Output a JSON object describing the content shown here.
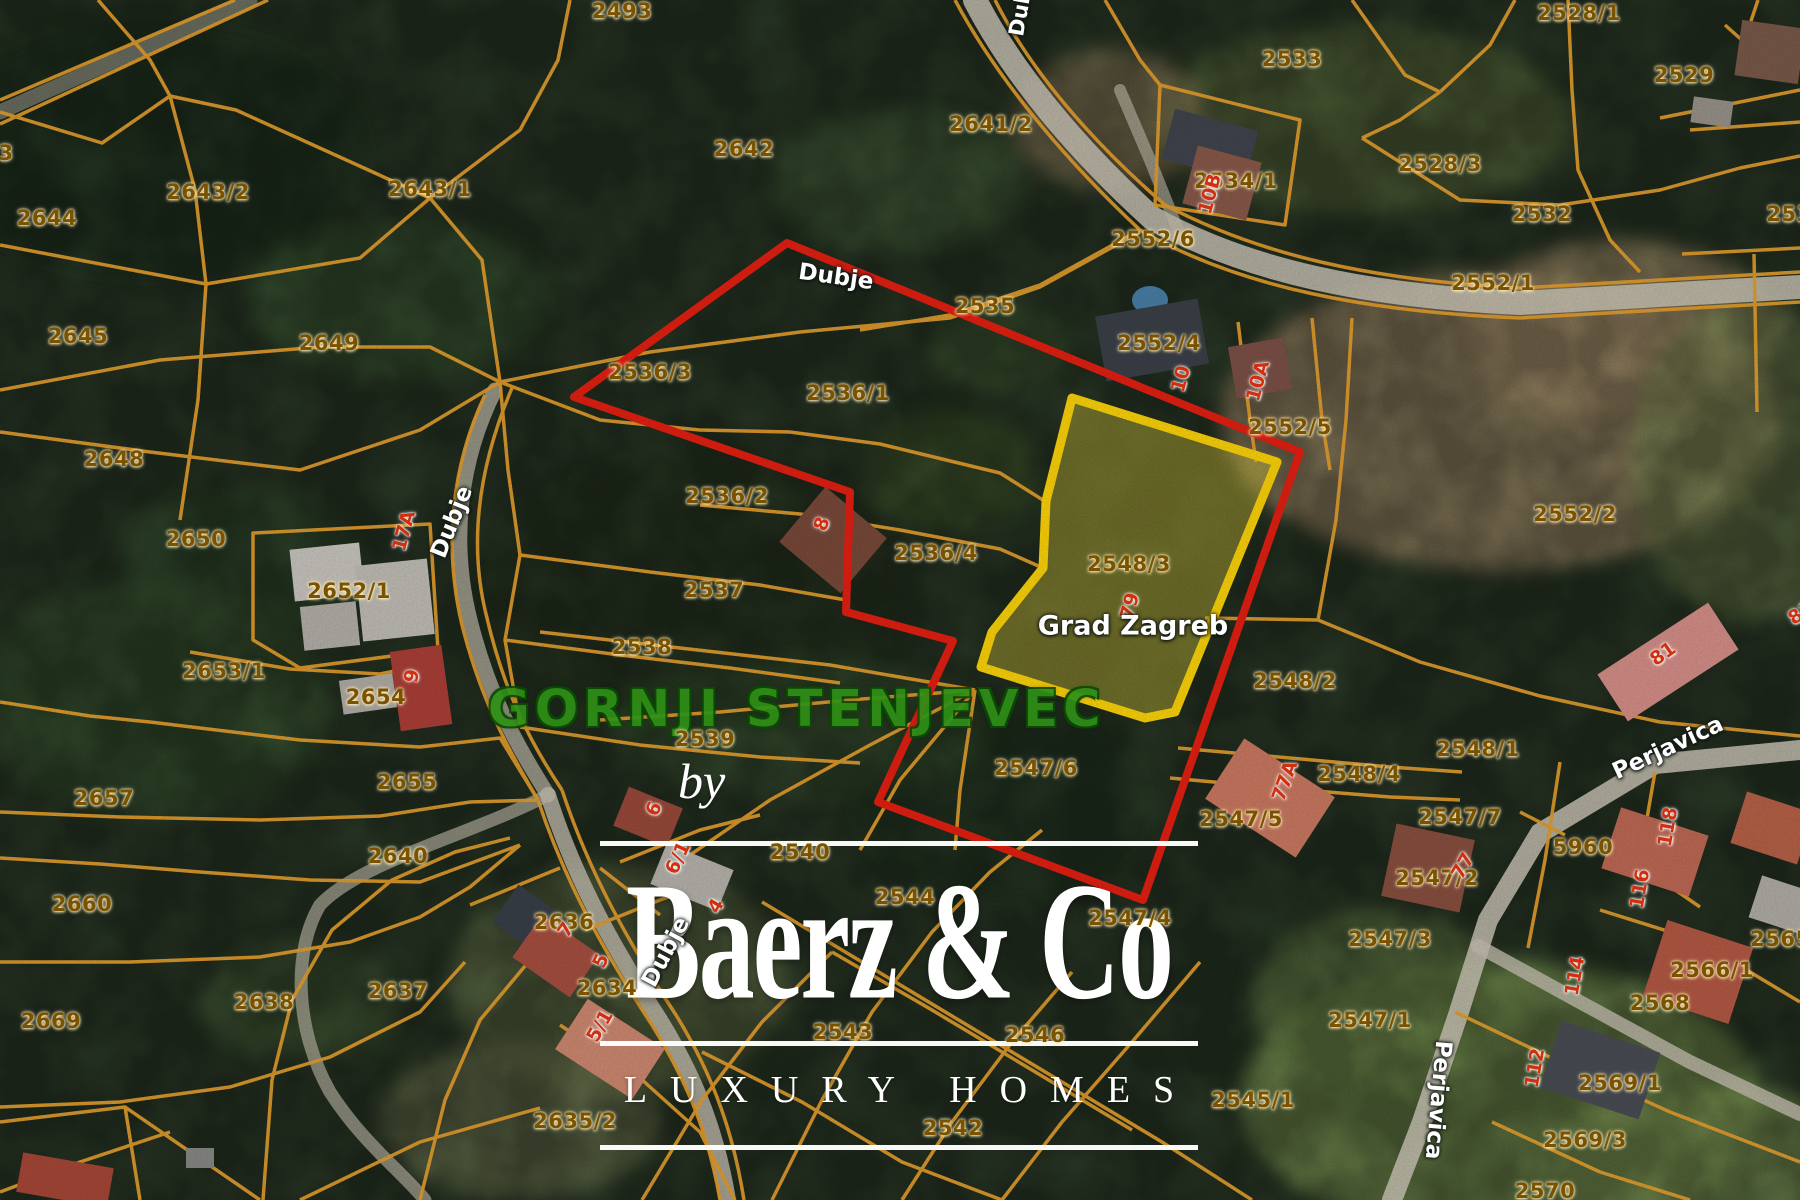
{
  "map": {
    "region_label": "GORNJI STENJEVEC",
    "highlighted_parcel": "2548/3",
    "colors": {
      "boundary_red": "#e62012",
      "parcel_highlight_yellow": "#ffd60a",
      "cadastral_orange": "#e6a02e",
      "parcel_text": "#7a5200",
      "house_number_red": "#d03010",
      "watermark_white": "#ffffff",
      "region_green": "#2f9016"
    },
    "parcel_labels": [
      {
        "t": "2493",
        "x": 622,
        "y": 11
      },
      {
        "t": "2643/2",
        "x": 208,
        "y": 192
      },
      {
        "t": "2643/1",
        "x": 430,
        "y": 189
      },
      {
        "t": "2644",
        "x": 47,
        "y": 218
      },
      {
        "t": "2642",
        "x": 744,
        "y": 149
      },
      {
        "t": "2641/2",
        "x": 991,
        "y": 124
      },
      {
        "t": "2645",
        "x": 78,
        "y": 336
      },
      {
        "t": "2649",
        "x": 329,
        "y": 343
      },
      {
        "t": "2648",
        "x": 114,
        "y": 459
      },
      {
        "t": "2650",
        "x": 196,
        "y": 539
      },
      {
        "t": "2652/1",
        "x": 349,
        "y": 591
      },
      {
        "t": "2653/1",
        "x": 224,
        "y": 671
      },
      {
        "t": "2654",
        "x": 376,
        "y": 697
      },
      {
        "t": "2655",
        "x": 407,
        "y": 782
      },
      {
        "t": "2657",
        "x": 104,
        "y": 798
      },
      {
        "t": "2660",
        "x": 82,
        "y": 904
      },
      {
        "t": "2669",
        "x": 51,
        "y": 1021
      },
      {
        "t": "2638",
        "x": 264,
        "y": 1002
      },
      {
        "t": "2637",
        "x": 398,
        "y": 991
      },
      {
        "t": "2640",
        "x": 398,
        "y": 856
      },
      {
        "t": "2636",
        "x": 564,
        "y": 922
      },
      {
        "t": "2634",
        "x": 607,
        "y": 988
      },
      {
        "t": "2635/2",
        "x": 575,
        "y": 1121
      },
      {
        "t": "2535",
        "x": 985,
        "y": 306
      },
      {
        "t": "2536/3",
        "x": 650,
        "y": 372
      },
      {
        "t": "2536/1",
        "x": 848,
        "y": 393
      },
      {
        "t": "2536/2",
        "x": 727,
        "y": 496
      },
      {
        "t": "2536/4",
        "x": 936,
        "y": 553
      },
      {
        "t": "2537",
        "x": 714,
        "y": 590
      },
      {
        "t": "2538",
        "x": 642,
        "y": 647
      },
      {
        "t": "2539",
        "x": 705,
        "y": 739
      },
      {
        "t": "2540",
        "x": 800,
        "y": 852
      },
      {
        "t": "2543",
        "x": 843,
        "y": 1032
      },
      {
        "t": "2544",
        "x": 905,
        "y": 897
      },
      {
        "t": "2546",
        "x": 1035,
        "y": 1035
      },
      {
        "t": "2542",
        "x": 953,
        "y": 1128
      },
      {
        "t": "2552/6",
        "x": 1153,
        "y": 239
      },
      {
        "t": "2534/1",
        "x": 1236,
        "y": 181
      },
      {
        "t": "2552/4",
        "x": 1159,
        "y": 343
      },
      {
        "t": "2552/5",
        "x": 1290,
        "y": 427
      },
      {
        "t": "2552/1",
        "x": 1493,
        "y": 283
      },
      {
        "t": "2552/2",
        "x": 1575,
        "y": 514
      },
      {
        "t": "2528/1",
        "x": 1579,
        "y": 13
      },
      {
        "t": "2533",
        "x": 1292,
        "y": 59
      },
      {
        "t": "2529",
        "x": 1684,
        "y": 75
      },
      {
        "t": "2528/3",
        "x": 1440,
        "y": 164
      },
      {
        "t": "2532",
        "x": 1542,
        "y": 214
      },
      {
        "t": "253",
        "x": 1789,
        "y": 214
      },
      {
        "t": "2548/3",
        "x": 1129,
        "y": 564
      },
      {
        "t": "2548/2",
        "x": 1295,
        "y": 681
      },
      {
        "t": "2548/1",
        "x": 1478,
        "y": 749
      },
      {
        "t": "2548/4",
        "x": 1359,
        "y": 774
      },
      {
        "t": "2547/6",
        "x": 1036,
        "y": 768
      },
      {
        "t": "2547/5",
        "x": 1241,
        "y": 819
      },
      {
        "t": "2547/7",
        "x": 1460,
        "y": 817
      },
      {
        "t": "2547/2",
        "x": 1437,
        "y": 878
      },
      {
        "t": "2547/3",
        "x": 1390,
        "y": 939
      },
      {
        "t": "2547/1",
        "x": 1370,
        "y": 1020
      },
      {
        "t": "2547/4",
        "x": 1130,
        "y": 918
      },
      {
        "t": "5960",
        "x": 1583,
        "y": 847
      },
      {
        "t": "2565/1",
        "x": 1792,
        "y": 939
      },
      {
        "t": "2566/1",
        "x": 1712,
        "y": 970
      },
      {
        "t": "2568",
        "x": 1660,
        "y": 1003
      },
      {
        "t": "2569/1",
        "x": 1620,
        "y": 1083
      },
      {
        "t": "2569/3",
        "x": 1585,
        "y": 1140
      },
      {
        "t": "2570",
        "x": 1545,
        "y": 1191
      },
      {
        "t": "2545/1",
        "x": 1253,
        "y": 1100
      },
      {
        "t": "3",
        "x": 6,
        "y": 153
      }
    ],
    "house_numbers": [
      {
        "t": "17A",
        "x": 404,
        "y": 531,
        "r": -75
      },
      {
        "t": "9",
        "x": 412,
        "y": 676,
        "r": -80
      },
      {
        "t": "8",
        "x": 822,
        "y": 524,
        "r": -70
      },
      {
        "t": "6",
        "x": 654,
        "y": 809,
        "r": -65
      },
      {
        "t": "6/1",
        "x": 678,
        "y": 858,
        "r": -65
      },
      {
        "t": "4",
        "x": 716,
        "y": 906,
        "r": -60
      },
      {
        "t": "5",
        "x": 601,
        "y": 961,
        "r": -65
      },
      {
        "t": "5/1",
        "x": 600,
        "y": 1026,
        "r": -60
      },
      {
        "t": "7",
        "x": 566,
        "y": 930,
        "r": -55
      },
      {
        "t": "10B",
        "x": 1210,
        "y": 194,
        "r": -75
      },
      {
        "t": "10",
        "x": 1181,
        "y": 379,
        "r": -75
      },
      {
        "t": "10A",
        "x": 1258,
        "y": 381,
        "r": -75
      },
      {
        "t": "79",
        "x": 1130,
        "y": 606,
        "r": -75
      },
      {
        "t": "77A",
        "x": 1285,
        "y": 781,
        "r": -70
      },
      {
        "t": "77",
        "x": 1463,
        "y": 866,
        "r": -60
      },
      {
        "t": "81",
        "x": 1663,
        "y": 654,
        "r": -35
      },
      {
        "t": "81",
        "x": 1801,
        "y": 613,
        "r": -35
      },
      {
        "t": "118",
        "x": 1668,
        "y": 827,
        "r": -80
      },
      {
        "t": "116",
        "x": 1640,
        "y": 889,
        "r": -80
      },
      {
        "t": "114",
        "x": 1575,
        "y": 976,
        "r": -80
      },
      {
        "t": "112",
        "x": 1535,
        "y": 1068,
        "r": -80
      }
    ],
    "street_labels": [
      {
        "t": "Dubje",
        "x": 836,
        "y": 277,
        "r": 8
      },
      {
        "t": "Dubje",
        "x": 452,
        "y": 522,
        "r": -68
      },
      {
        "t": "Dubje",
        "x": 666,
        "y": 952,
        "r": -62
      },
      {
        "t": "Dubje",
        "x": 1022,
        "y": 2,
        "r": -80,
        "s": 21
      },
      {
        "t": "Grad Zagreb",
        "x": 1133,
        "y": 626,
        "r": 0,
        "s": 27
      },
      {
        "t": "Perjavica",
        "x": 1668,
        "y": 748,
        "r": -25
      },
      {
        "t": "Perjavica",
        "x": 1438,
        "y": 1100,
        "r": 95
      }
    ]
  },
  "watermark": {
    "by": "by",
    "brand": "Baerz & Co",
    "tagline": "LUXURY HOMES"
  }
}
